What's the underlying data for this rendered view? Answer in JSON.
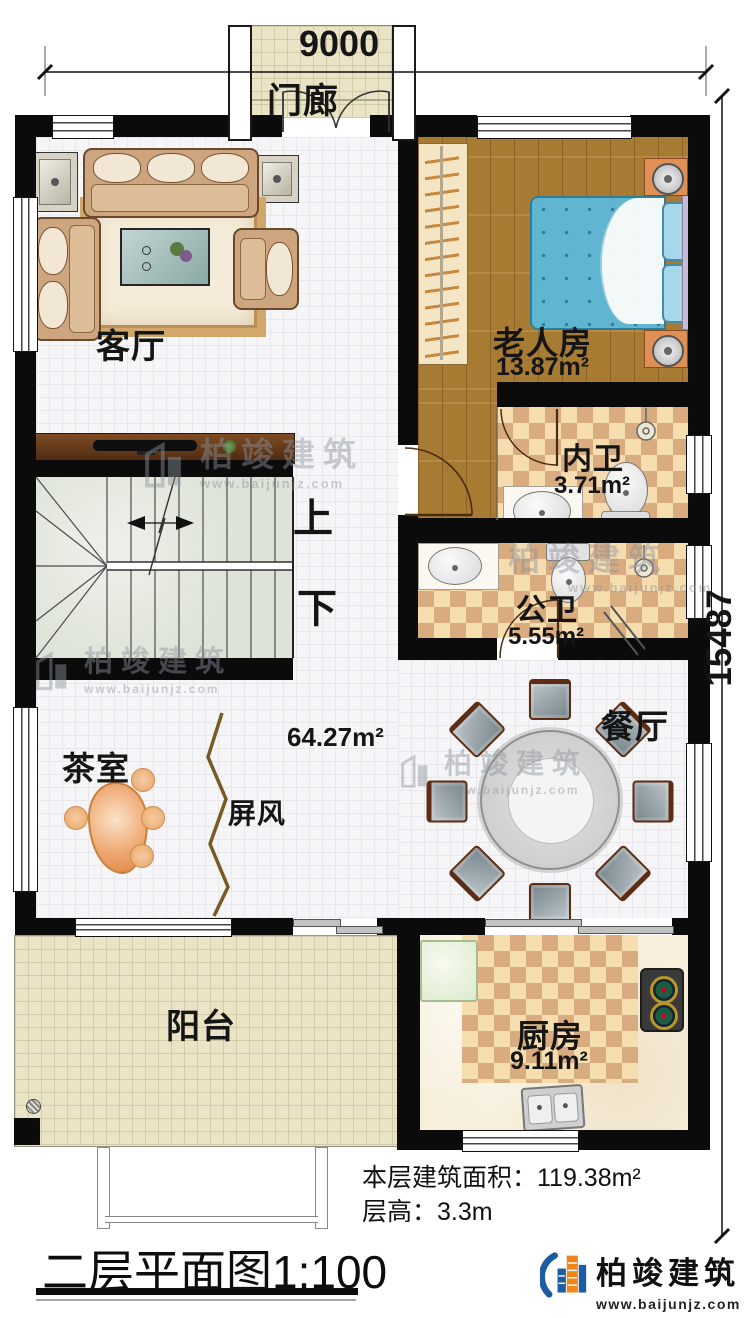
{
  "dimensions": {
    "top": "9000",
    "right": "15487"
  },
  "rooms": {
    "porch": {
      "label": "门廊"
    },
    "living_room": {
      "label": "客厅"
    },
    "elderly_room": {
      "label": "老人房",
      "area": "13.87m²"
    },
    "inner_bathroom": {
      "label": "内卫",
      "area": "3.71m²"
    },
    "public_bathroom": {
      "label": "公卫",
      "area": "5.55m²"
    },
    "hall": {
      "area": "64.27m²"
    },
    "tea_room": {
      "label": "茶室"
    },
    "screen": {
      "label": "屏风"
    },
    "dining_room": {
      "label": "餐厅"
    },
    "balcony": {
      "label": "阳台"
    },
    "kitchen": {
      "label": "厨房",
      "area": "9.11m²"
    }
  },
  "stairs": {
    "up_label": "上",
    "down_label": "下"
  },
  "footer": {
    "floor_area": "本层建筑面积：119.38m²",
    "floor_height": "层高：3.3m",
    "title": "二层平面图",
    "scale": "1:100"
  },
  "brand": {
    "name": "柏竣建筑",
    "website": "www.baijunjz.com"
  },
  "watermark": {
    "name": "柏竣建筑",
    "website": "www.baijunjz.com"
  },
  "colors": {
    "wall": "#0b0b0b",
    "wood_floor": "#a87b33",
    "checker_light": "#f6ddb0",
    "checker_dark": "#d9ac80",
    "bed_blue": "#60b6d1",
    "stair_green": "#dde3d7",
    "logo_blue": "#1b5da0",
    "logo_orange": "#f08519"
  }
}
